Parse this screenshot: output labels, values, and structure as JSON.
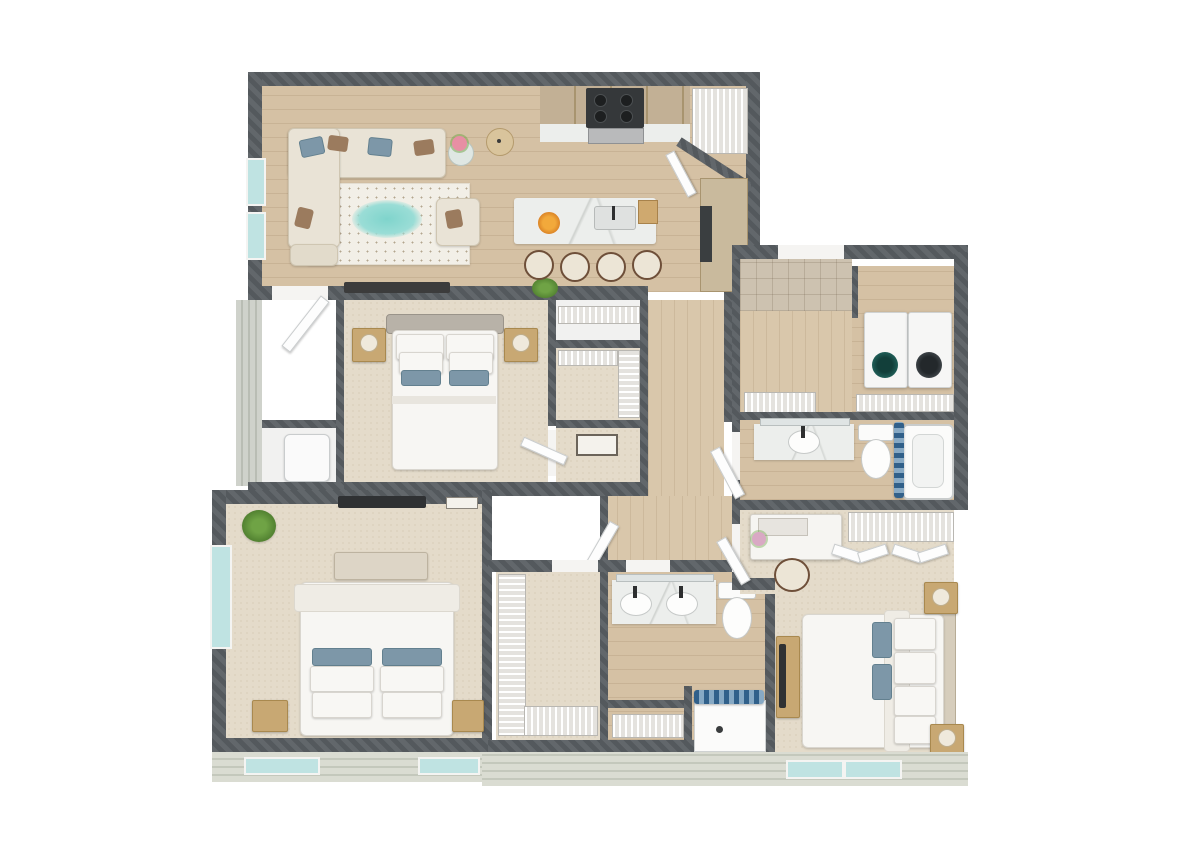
{
  "meta": {
    "description": "3D aerial dollhouse-style rendering of a three-bedroom, two-bathroom apartment floor plan on a white background",
    "view": "isometric top-down",
    "visible_text": "none"
  },
  "palette": {
    "background": "#ffffff",
    "wall_dark": "#5b6064",
    "wall_hatch_light": "#6a6f73",
    "hardwood": "#d5c1a4",
    "carpet": "#e4dbca",
    "entry_tile_gray": "#9fa5a7",
    "hall_tile_beige": "#cdc2b0",
    "siding_exterior": "#d9dcd2",
    "window_glass_teal": "#bfe3e2",
    "marble_counter": "#eceeec",
    "cabinet_wood": "#c2b095",
    "accent_pillow_blue": "#7d97a8",
    "shower_curtain_blue": "#31608a",
    "rug_cream": "#f2efe7",
    "rug_accent_teal": "#7fd4cc",
    "plant_green": "#6fa345"
  },
  "rooms": [
    {
      "name": "Living Room",
      "floor": "hardwood",
      "furniture": [
        "sectional-sofa",
        "blue-and-brown-accent-pillows",
        "patterned-area-rug-with-teal-accent",
        "armchair",
        "glass-side-table-with-flowers",
        "floor-lamp",
        "media-console",
        "potted-plant"
      ]
    },
    {
      "name": "Kitchen",
      "floor": "hardwood",
      "furniture": [
        "upper-wood-cabinets",
        "marble-counters",
        "range-with-oven",
        "kitchen-island-with-sink",
        "fruit-bowl",
        "grocery-bag",
        "four-bar-stools",
        "tall-cabinet-with-refrigerator"
      ]
    },
    {
      "name": "Corner Pantry",
      "floor": "hardwood",
      "furniture": [
        "wire-shelving",
        "angled-door"
      ]
    },
    {
      "name": "Entry",
      "floor": "gray-tile",
      "furniture": [
        "open-front-door"
      ]
    },
    {
      "name": "Utility Closet",
      "floor": "white",
      "furniture": [
        "water-heater"
      ]
    },
    {
      "name": "Bedroom 2",
      "floor": "carpet",
      "furniture": [
        "queen-bed-gray-upholstered-headboard",
        "two-wood-nightstands",
        "two-table-lamps",
        "blue-accent-pillows"
      ]
    },
    {
      "name": "Bedroom 2 Closets",
      "floor": "carpet",
      "furniture": [
        "linen-closet-wire-shelf",
        "walk-in-closet-wire-shelving",
        "wall-art"
      ]
    },
    {
      "name": "Hallway",
      "floor": "hardwood",
      "furniture": []
    },
    {
      "name": "Entry Hall",
      "floor": "beige-tile",
      "furniture": [
        "linen-closet-wire-shelf"
      ]
    },
    {
      "name": "Laundry Room",
      "floor": "hardwood",
      "furniture": [
        "front-load-washer",
        "front-load-dryer",
        "wire-shelf"
      ]
    },
    {
      "name": "Bathroom 2",
      "floor": "hardwood",
      "furniture": [
        "vanity-with-sink",
        "mirror",
        "toilet",
        "waste-bin",
        "bathtub",
        "blue-shower-curtain"
      ]
    },
    {
      "name": "Primary Bedroom",
      "floor": "carpet",
      "furniture": [
        "king-bed",
        "upholstered-bench",
        "blue-accent-pillows",
        "two-wood-nightstands",
        "wall-mounted-tv",
        "potted-plant",
        "windows"
      ]
    },
    {
      "name": "Primary Walk-in Closet",
      "floor": "carpet",
      "furniture": [
        "l-shaped-wire-shelving"
      ]
    },
    {
      "name": "Primary Bathroom",
      "floor": "hardwood",
      "furniture": [
        "double-vanity-two-sinks",
        "mirrors",
        "toilet",
        "linen-closet-wire-shelf",
        "walk-in-shower",
        "blue-shower-curtain"
      ]
    },
    {
      "name": "Bedroom 3",
      "floor": "carpet",
      "furniture": [
        "queen-bed",
        "two-wood-nightstands-with-lamps",
        "makeup-vanity-desk-with-mirror",
        "vanity-chair",
        "dresser-with-tv",
        "double-bifold-closet-with-wire-shelf"
      ]
    }
  ],
  "exterior": {
    "wall_finish": "dark-gray-diagonal-hatch",
    "siding": "pale-sage-horizontal-lap-siding",
    "window_count_visible": 8,
    "window_glass": "pale-teal"
  }
}
